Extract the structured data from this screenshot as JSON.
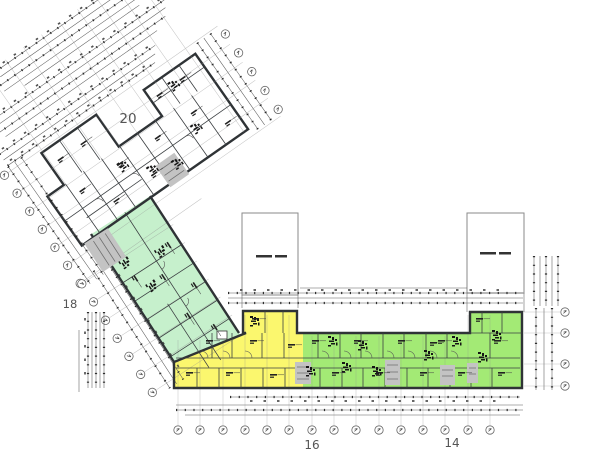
{
  "plan": {
    "labels": {
      "wing20": "20",
      "wing18": "18",
      "wing16": "16",
      "wing14": "14"
    },
    "colors": {
      "wing20": "#4cdfe8",
      "wing18": "#c6f0cc",
      "wing16": "#fbf76e",
      "wing14": "#a3ea75",
      "stair": "#c3c3c3",
      "wall": "#333333",
      "number": "#555555"
    }
  }
}
